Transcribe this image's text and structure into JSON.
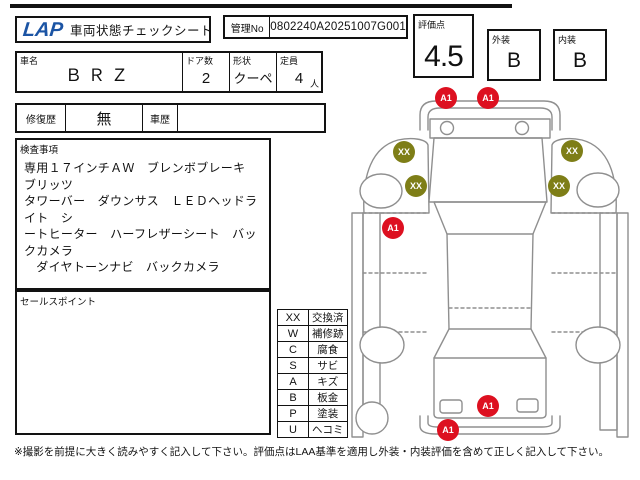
{
  "header": {
    "logo": "LAP",
    "logo_color": "#1b54a4",
    "title": "車両状態チェックシート",
    "mgmt_label": "管理No",
    "mgmt_value": "0802240A20251007G001",
    "score_label": "評価点",
    "score_value": "4.5",
    "exterior_label": "外装",
    "exterior_value": "B",
    "interior_label": "内装",
    "interior_value": "B"
  },
  "vehicle": {
    "name_label": "車名",
    "name_value": "ＢＲＺ",
    "doors_label": "ドア数",
    "doors_value": "2",
    "shape_label": "形状",
    "shape_value": "クーペ",
    "capacity_label": "定員",
    "capacity_value": "4",
    "capacity_unit": "人"
  },
  "history": {
    "repair_label": "修復歴",
    "repair_value": "無",
    "car_history_label": "車歴",
    "car_history_value": ""
  },
  "inspection": {
    "label": "検査事項",
    "lines": [
      "専用１７インチＡＷ　ブレンボブレーキ　ブリッツ",
      "タワーバー　ダウンサス　ＬＥＤヘッドライト　シ",
      "ートヒーター　ハーフレザーシート　バックカメラ",
      "　ダイヤトーンナビ　バックカメラ"
    ]
  },
  "sales_point": {
    "label": "セールスポイント",
    "value": ""
  },
  "legend": {
    "rows": [
      {
        "code": "XX",
        "meaning": "交換済"
      },
      {
        "code": "W",
        "meaning": "補修跡"
      },
      {
        "code": "C",
        "meaning": "腐食"
      },
      {
        "code": "S",
        "meaning": "サビ"
      },
      {
        "code": "A",
        "meaning": "キズ"
      },
      {
        "code": "B",
        "meaning": "板金"
      },
      {
        "code": "P",
        "meaning": "塗装"
      },
      {
        "code": "U",
        "meaning": "ヘコミ"
      }
    ]
  },
  "diagram": {
    "markers": [
      {
        "label": "A1",
        "type": "scratch",
        "color": "#dd1020",
        "x": 96,
        "y": 13
      },
      {
        "label": "A1",
        "type": "scratch",
        "color": "#dd1020",
        "x": 138,
        "y": 13
      },
      {
        "label": "XX",
        "type": "replaced",
        "color": "#7e7e17",
        "x": 54,
        "y": 67
      },
      {
        "label": "XX",
        "type": "replaced",
        "color": "#7e7e17",
        "x": 222,
        "y": 66
      },
      {
        "label": "XX",
        "type": "replaced",
        "color": "#7e7e17",
        "x": 66,
        "y": 101
      },
      {
        "label": "XX",
        "type": "replaced",
        "color": "#7e7e17",
        "x": 209,
        "y": 101
      },
      {
        "label": "A1",
        "type": "scratch",
        "color": "#dd1020",
        "x": 43,
        "y": 143
      },
      {
        "label": "A1",
        "type": "scratch",
        "color": "#dd1020",
        "x": 138,
        "y": 321
      },
      {
        "label": "A1",
        "type": "scratch",
        "color": "#dd1020",
        "x": 98,
        "y": 345
      }
    ]
  },
  "footer": {
    "note": "※撮影を前提に大きく読みやすく記入して下さい。評価点はLAA基準を適用し外装・内装評価を含めて正しく記入して下さい。"
  },
  "colors": {
    "marker_red": "#dd1020",
    "marker_olive": "#7e7e17",
    "diagram_line": "#8f8f8f"
  }
}
